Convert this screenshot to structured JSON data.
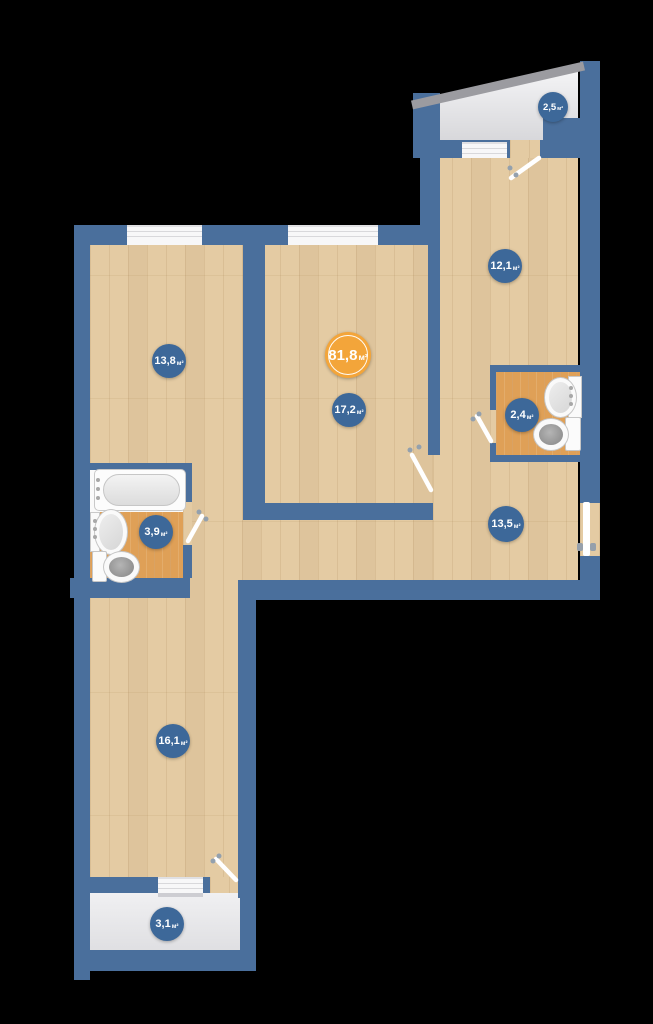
{
  "plan": {
    "unit": "м²",
    "rooms": [
      {
        "id": "balcony-top",
        "area": "2,5"
      },
      {
        "id": "room-12-1",
        "area": "12,1"
      },
      {
        "id": "room-13-8",
        "area": "13,8"
      },
      {
        "id": "total",
        "area": "81,8"
      },
      {
        "id": "room-17-2",
        "area": "17,2"
      },
      {
        "id": "bathroom-2-4",
        "area": "2,4"
      },
      {
        "id": "bathroom-3-9",
        "area": "3,9"
      },
      {
        "id": "hallway-13-5",
        "area": "13,5"
      },
      {
        "id": "room-16-1",
        "area": "16,1"
      },
      {
        "id": "balcony-bottom",
        "area": "3,1"
      }
    ],
    "colors": {
      "wall": "#4a6f9c",
      "label_blue": "#3d6899",
      "total_orange": "#f3a53a",
      "wood_floor": "#e4cba3",
      "tile_floor": "#dfa057",
      "balcony_floor": "#e8e8ea"
    }
  }
}
